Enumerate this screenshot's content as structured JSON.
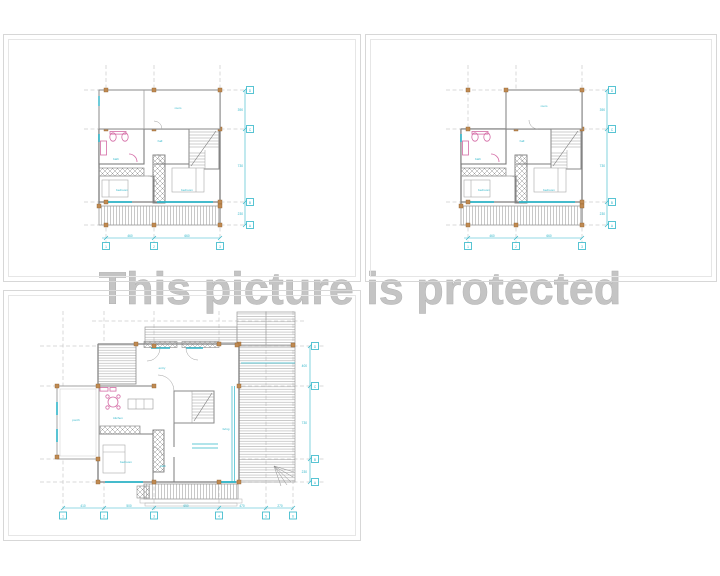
{
  "watermark": {
    "text": "This picture is protected"
  },
  "colors": {
    "dimension_cyan": "#2fb6c9",
    "fixture_magenta": "#d46ba5",
    "column_orange": "#c08a52",
    "wall_gray": "#7d7d7d",
    "hatch_gray": "#9b9b9b",
    "grid_gray": "#b5b5b5",
    "panel_border": "#d7d7d7",
    "watermark_gray": "#c4c4c4"
  },
  "plan_upper": {
    "rooms": {
      "top": "room",
      "hall": "hall",
      "bath": "bath",
      "bed_left": "bedroom",
      "bed_right": "bedroom"
    },
    "dims_bottom": [
      "460",
      "660"
    ],
    "dims_right": [
      "390",
      "730",
      "230"
    ],
    "grid_cols": [
      "1",
      "2",
      "3"
    ],
    "grid_rows": [
      "D",
      "C",
      "B",
      "A"
    ]
  },
  "plan_ground": {
    "rooms": {
      "porch": "porch",
      "kitchen": "kitchen",
      "entry": "entry",
      "bedroom": "bedroom",
      "bath": "bath",
      "living": "living"
    },
    "dims_bottom": [
      "410",
      "500",
      "650",
      "470",
      "270"
    ],
    "dims_right": [
      "400",
      "730",
      "230"
    ],
    "grid_cols": [
      "1",
      "2",
      "3",
      "4",
      "5",
      "6"
    ],
    "grid_rows": [
      "D",
      "C",
      "B",
      "A"
    ]
  }
}
